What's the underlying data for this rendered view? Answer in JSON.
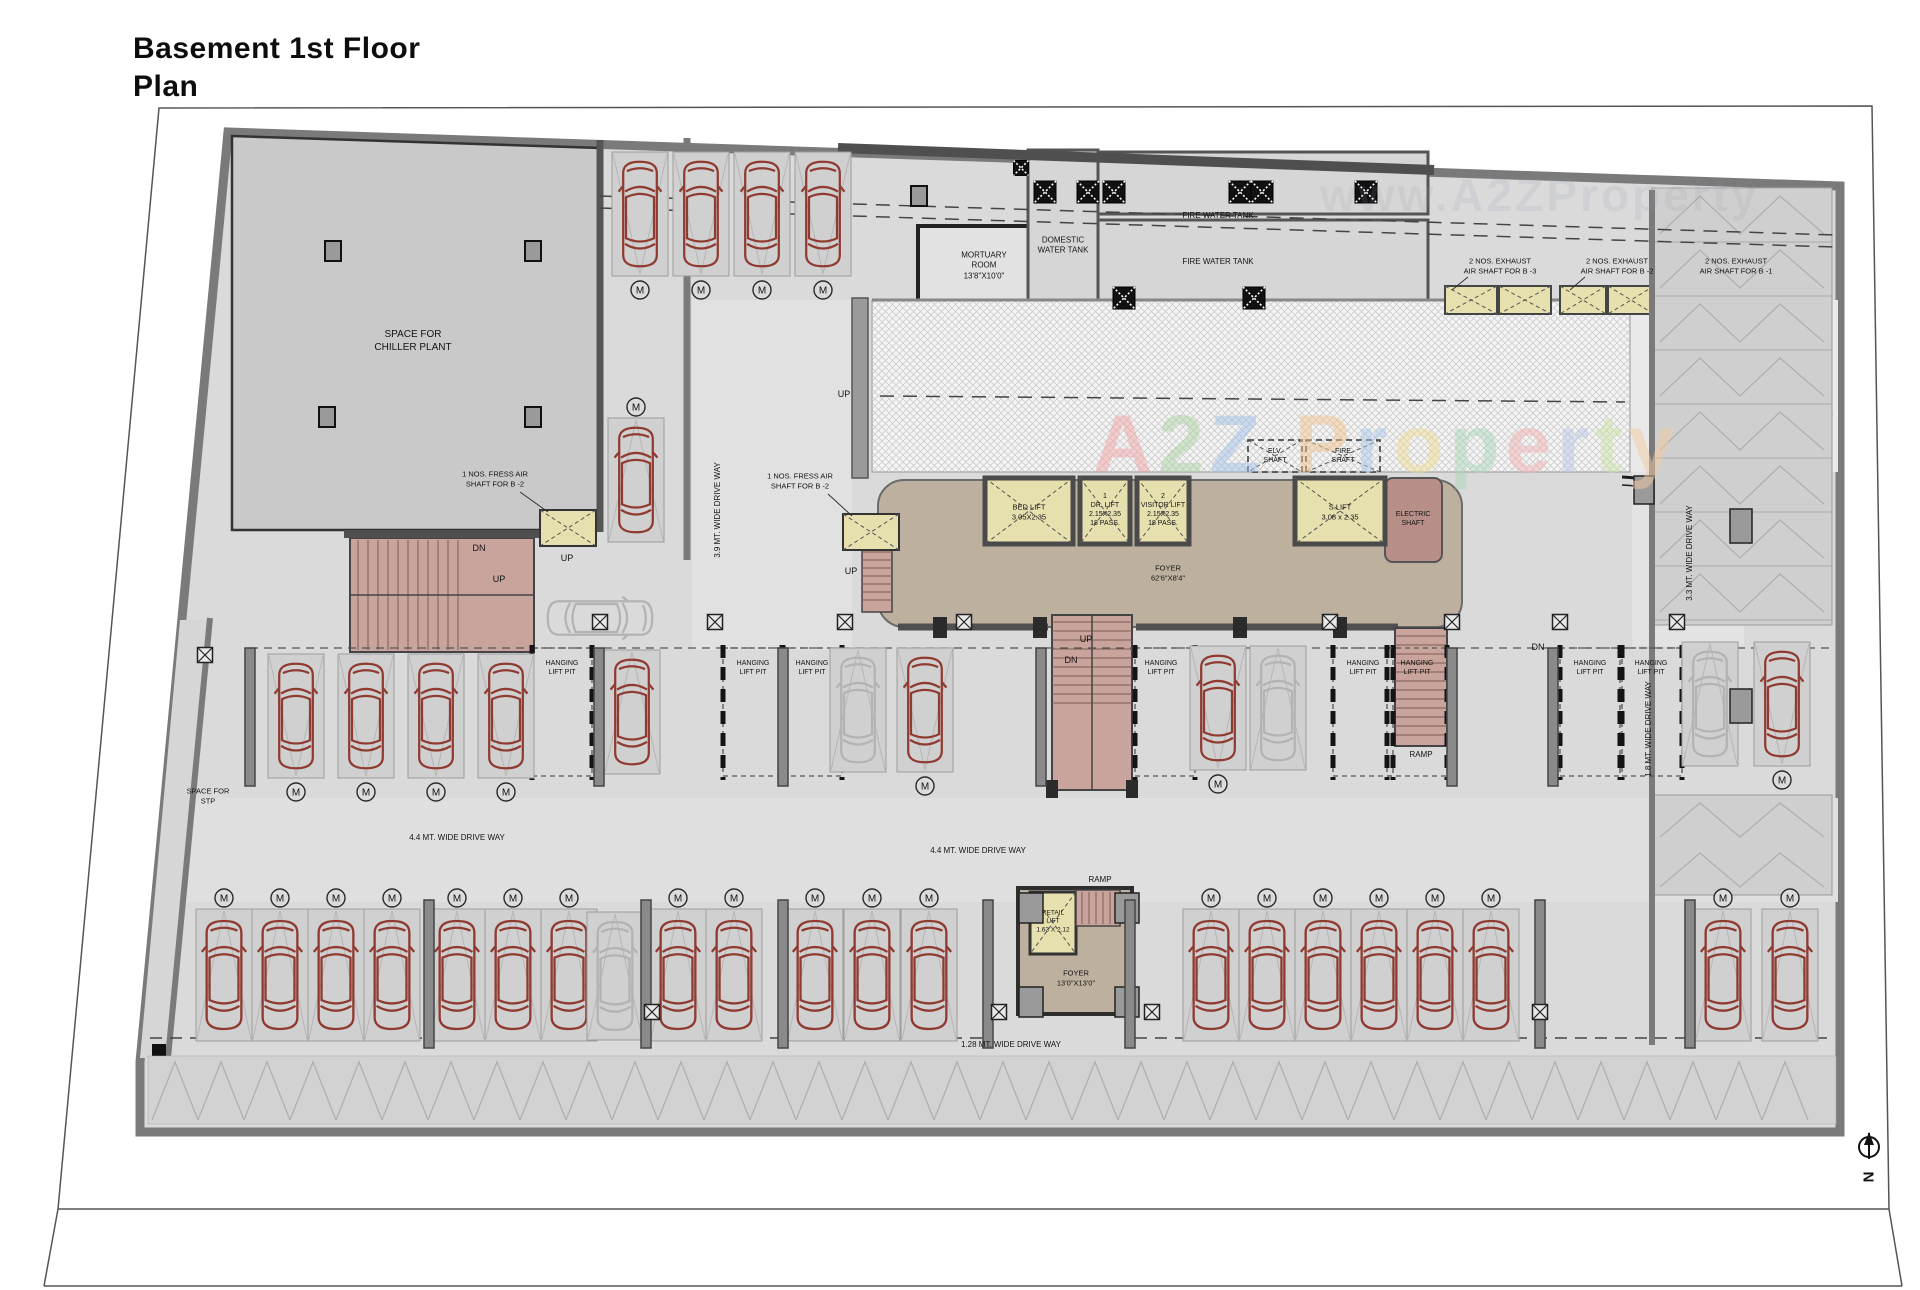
{
  "title": "Basement 1st Floor Plan",
  "north_label": "N",
  "m_badge": "M",
  "watermark": {
    "faint": "www.A2ZProperty",
    "letters": [
      {
        "ch": "A",
        "c": "#f2a6a6"
      },
      {
        "ch": "2",
        "c": "#aed3a4"
      },
      {
        "ch": "Z",
        "c": "#a3c1e8"
      },
      {
        "ch": " ",
        "c": "#ffffff"
      },
      {
        "ch": "P",
        "c": "#f3c492"
      },
      {
        "ch": "r",
        "c": "#a9c9ec"
      },
      {
        "ch": "o",
        "c": "#f0dc96"
      },
      {
        "ch": "p",
        "c": "#abd8bc"
      },
      {
        "ch": "e",
        "c": "#f2b2b2"
      },
      {
        "ch": "r",
        "c": "#b9c9e9"
      },
      {
        "ch": "t",
        "c": "#cce3a6"
      },
      {
        "ch": "y",
        "c": "#f3cba2"
      }
    ]
  },
  "colors": {
    "wall_heavy": "#4f4f4f",
    "wall_mid": "#7a7a7a",
    "building_fill": "#dadada",
    "room_fill": "#c9c9c9",
    "stair_pink": "#c9a49c",
    "lift_yellow": "#e6dfae",
    "foyer_tan": "#bdb09e",
    "electric_brown": "#b78f88",
    "car_red": "#8f3b31",
    "car_gray": "#b3b3b3"
  },
  "labels": [
    {
      "id": "chiller-plant",
      "t": "SPACE FOR\nCHILLER PLANT",
      "x": 413,
      "y": 341,
      "s": 10
    },
    {
      "id": "mortuary-room",
      "t": "MORTUARY\nROOM\n13'8\"X10'0\"",
      "x": 984,
      "y": 266,
      "s": 8
    },
    {
      "id": "domestic-water-tank",
      "t": "DOMESTIC\nWATER TANK",
      "x": 1063,
      "y": 246,
      "s": 8
    },
    {
      "id": "fire-water-tank-1",
      "t": "FIRE WATER TANK",
      "x": 1218,
      "y": 216,
      "s": 8
    },
    {
      "id": "fire-water-tank-2",
      "t": "FIRE WATER TANK",
      "x": 1218,
      "y": 262,
      "s": 8
    },
    {
      "id": "exhaust-shaft-b3",
      "t": "2 NOS. EXHAUST\nAIR SHAFT FOR B -3",
      "x": 1500,
      "y": 266,
      "s": 7.5
    },
    {
      "id": "exhaust-shaft-b2",
      "t": "2 NOS. EXHAUST\nAIR SHAFT FOR B -2",
      "x": 1617,
      "y": 266,
      "s": 7.5
    },
    {
      "id": "exhaust-shaft-b1",
      "t": "2 NOS. EXHAUST\nAIR SHAFT FOR B -1",
      "x": 1736,
      "y": 266,
      "s": 7.5
    },
    {
      "id": "fresh-air-shaft-1",
      "t": "1 NOS. FRESS AIR\nSHAFT FOR B -2",
      "x": 495,
      "y": 479,
      "s": 7.5
    },
    {
      "id": "fresh-air-shaft-2",
      "t": "1 NOS. FRESS AIR\nSHAFT FOR B -2",
      "x": 800,
      "y": 481,
      "s": 7.5
    },
    {
      "id": "up-ramp",
      "t": "UP",
      "x": 844,
      "y": 395,
      "s": 9
    },
    {
      "id": "bed-lift",
      "t": "BED LIFT\n3.05X2.35",
      "x": 1029,
      "y": 512,
      "s": 7.5
    },
    {
      "id": "dr-lift",
      "t": "1\nDR. LIFT\n2.15X2.35\n18 PASS.",
      "x": 1105,
      "y": 510,
      "s": 7
    },
    {
      "id": "visitor-lift",
      "t": "2\nVISITOR LIFT\n2.15X2.35\n18 PASS.",
      "x": 1163,
      "y": 510,
      "s": 7
    },
    {
      "id": "s-lift",
      "t": "S.LIFT\n3.08 x 2.35",
      "x": 1340,
      "y": 512,
      "s": 7.5
    },
    {
      "id": "elv-shaft",
      "t": "ELV.\nSHAFT",
      "x": 1275,
      "y": 456,
      "s": 7
    },
    {
      "id": "fire-shaft",
      "t": "FIRE\nSHAFT",
      "x": 1343,
      "y": 456,
      "s": 7
    },
    {
      "id": "electric-shaft",
      "t": "ELECTRIC\nSHAFT",
      "x": 1413,
      "y": 519,
      "s": 7
    },
    {
      "id": "foyer-main",
      "t": "FOYER\n62'6\"X8'4\"",
      "x": 1168,
      "y": 573,
      "s": 7.5
    },
    {
      "id": "dn-left-stair",
      "t": "DN",
      "x": 479,
      "y": 549,
      "s": 9
    },
    {
      "id": "up-left-stair",
      "t": "UP",
      "x": 499,
      "y": 580,
      "s": 9
    },
    {
      "id": "up-left-landing",
      "t": "UP",
      "x": 567,
      "y": 559,
      "s": 9
    },
    {
      "id": "up-foyer-left",
      "t": "UP",
      "x": 851,
      "y": 572,
      "s": 9
    },
    {
      "id": "up-central-stair",
      "t": "UP",
      "x": 1086,
      "y": 640,
      "s": 9
    },
    {
      "id": "dn-central-stair",
      "t": "DN",
      "x": 1071,
      "y": 661,
      "s": 9
    },
    {
      "id": "dn-right",
      "t": "DN",
      "x": 1538,
      "y": 648,
      "s": 9
    },
    {
      "id": "hanging-lift-pit-1",
      "t": "HANGING\nLIFT PIT",
      "x": 562,
      "y": 668,
      "s": 7
    },
    {
      "id": "hanging-lift-pit-2",
      "t": "HANGING\nLIFT PIT",
      "x": 753,
      "y": 668,
      "s": 7
    },
    {
      "id": "hanging-lift-pit-3",
      "t": "HANGING\nLIFT PIT",
      "x": 812,
      "y": 668,
      "s": 7
    },
    {
      "id": "hanging-lift-pit-4",
      "t": "HANGING\nLIFT PIT",
      "x": 1161,
      "y": 668,
      "s": 7
    },
    {
      "id": "hanging-lift-pit-5",
      "t": "HANGING\nLIFT PIT",
      "x": 1363,
      "y": 668,
      "s": 7
    },
    {
      "id": "hanging-lift-pit-6",
      "t": "HANGING\nLIFT PIT",
      "x": 1417,
      "y": 668,
      "s": 7
    },
    {
      "id": "hanging-lift-pit-7",
      "t": "HANGING\nLIFT PIT",
      "x": 1590,
      "y": 668,
      "s": 7
    },
    {
      "id": "hanging-lift-pit-8",
      "t": "HANGING\nLIFT PIT",
      "x": 1651,
      "y": 668,
      "s": 7
    },
    {
      "id": "ramp-right",
      "t": "RAMP",
      "x": 1421,
      "y": 755,
      "s": 8
    },
    {
      "id": "ramp-bottom",
      "t": "RAMP",
      "x": 1100,
      "y": 880,
      "s": 8
    },
    {
      "id": "retail-lift",
      "t": "RETAIL\nLIFT\n1.63 X 2.12",
      "x": 1053,
      "y": 922,
      "s": 6.5
    },
    {
      "id": "foyer-retail",
      "t": "FOYER\n13'0\"X13'0\"",
      "x": 1076,
      "y": 978,
      "s": 7.5
    },
    {
      "id": "driveway-3-9",
      "t": "3.9 MT. WIDE DRIVE WAY",
      "x": 718,
      "y": 510,
      "s": 8,
      "r": -90
    },
    {
      "id": "driveway-3-3",
      "t": "3.3 MT. WIDE DRIVE WAY",
      "x": 1690,
      "y": 553,
      "s": 8,
      "r": -90
    },
    {
      "id": "driveway-1-8",
      "t": "1.8 MT. WIDE DRIVE WAY",
      "x": 1649,
      "y": 729,
      "s": 8,
      "r": -90
    },
    {
      "id": "driveway-4-4-left",
      "t": "4.4 MT. WIDE DRIVE WAY",
      "x": 457,
      "y": 838,
      "s": 8
    },
    {
      "id": "driveway-4-4-right",
      "t": "4.4 MT. WIDE DRIVE WAY",
      "x": 978,
      "y": 851,
      "s": 8
    },
    {
      "id": "driveway-1-28",
      "t": "1.28 MT. WIDE DRIVE WAY",
      "x": 1011,
      "y": 1045,
      "s": 8
    },
    {
      "id": "space-for-stp",
      "t": "SPACE FOR\nSTP",
      "x": 208,
      "y": 796,
      "s": 7.5
    }
  ],
  "cars": [
    {
      "x": 640,
      "y": 158,
      "h": 112,
      "c": "r",
      "m": "b"
    },
    {
      "x": 701,
      "y": 158,
      "h": 112,
      "c": "r",
      "m": "b"
    },
    {
      "x": 762,
      "y": 158,
      "h": 112,
      "c": "r",
      "m": "b"
    },
    {
      "x": 823,
      "y": 158,
      "h": 112,
      "c": "r",
      "m": "b"
    },
    {
      "x": 636,
      "y": 424,
      "h": 112,
      "c": "r",
      "m": "a"
    },
    {
      "x": 296,
      "y": 660,
      "h": 112,
      "c": "r",
      "m": "b"
    },
    {
      "x": 366,
      "y": 660,
      "h": 112,
      "c": "r",
      "m": "b"
    },
    {
      "x": 436,
      "y": 660,
      "h": 112,
      "c": "r",
      "m": "b"
    },
    {
      "x": 506,
      "y": 660,
      "h": 112,
      "c": "r",
      "m": "b"
    },
    {
      "x": 632,
      "y": 656,
      "h": 112,
      "c": "r"
    },
    {
      "x": 600,
      "y": 618,
      "h": 112,
      "c": "g",
      "rot": 90
    },
    {
      "x": 858,
      "y": 654,
      "h": 112,
      "c": "g"
    },
    {
      "x": 925,
      "y": 654,
      "h": 112,
      "c": "r",
      "m": "b"
    },
    {
      "x": 1218,
      "y": 652,
      "h": 112,
      "c": "r",
      "m": "b"
    },
    {
      "x": 1278,
      "y": 652,
      "h": 112,
      "c": "g"
    },
    {
      "x": 1710,
      "y": 648,
      "h": 112,
      "c": "g"
    },
    {
      "x": 1782,
      "y": 648,
      "h": 112,
      "c": "r",
      "m": "b"
    },
    {
      "x": 224,
      "y": 915,
      "h": 120,
      "c": "r",
      "m": "a"
    },
    {
      "x": 280,
      "y": 915,
      "h": 120,
      "c": "r",
      "m": "a"
    },
    {
      "x": 336,
      "y": 915,
      "h": 120,
      "c": "r",
      "m": "a"
    },
    {
      "x": 392,
      "y": 915,
      "h": 120,
      "c": "r",
      "m": "a"
    },
    {
      "x": 457,
      "y": 915,
      "h": 120,
      "c": "r",
      "m": "a"
    },
    {
      "x": 513,
      "y": 915,
      "h": 120,
      "c": "r",
      "m": "a"
    },
    {
      "x": 569,
      "y": 915,
      "h": 120,
      "c": "r",
      "m": "a"
    },
    {
      "x": 615,
      "y": 918,
      "h": 116,
      "c": "g"
    },
    {
      "x": 678,
      "y": 915,
      "h": 120,
      "c": "r",
      "m": "a"
    },
    {
      "x": 734,
      "y": 915,
      "h": 120,
      "c": "r",
      "m": "a"
    },
    {
      "x": 815,
      "y": 915,
      "h": 120,
      "c": "r",
      "m": "a"
    },
    {
      "x": 872,
      "y": 915,
      "h": 120,
      "c": "r",
      "m": "a"
    },
    {
      "x": 929,
      "y": 915,
      "h": 120,
      "c": "r",
      "m": "a"
    },
    {
      "x": 1211,
      "y": 915,
      "h": 120,
      "c": "r",
      "m": "a"
    },
    {
      "x": 1267,
      "y": 915,
      "h": 120,
      "c": "r",
      "m": "a"
    },
    {
      "x": 1323,
      "y": 915,
      "h": 120,
      "c": "r",
      "m": "a"
    },
    {
      "x": 1379,
      "y": 915,
      "h": 120,
      "c": "r",
      "m": "a"
    },
    {
      "x": 1435,
      "y": 915,
      "h": 120,
      "c": "r",
      "m": "a"
    },
    {
      "x": 1491,
      "y": 915,
      "h": 120,
      "c": "r",
      "m": "a"
    },
    {
      "x": 1723,
      "y": 915,
      "h": 120,
      "c": "r",
      "m": "a"
    },
    {
      "x": 1790,
      "y": 915,
      "h": 120,
      "c": "r",
      "m": "a"
    }
  ]
}
